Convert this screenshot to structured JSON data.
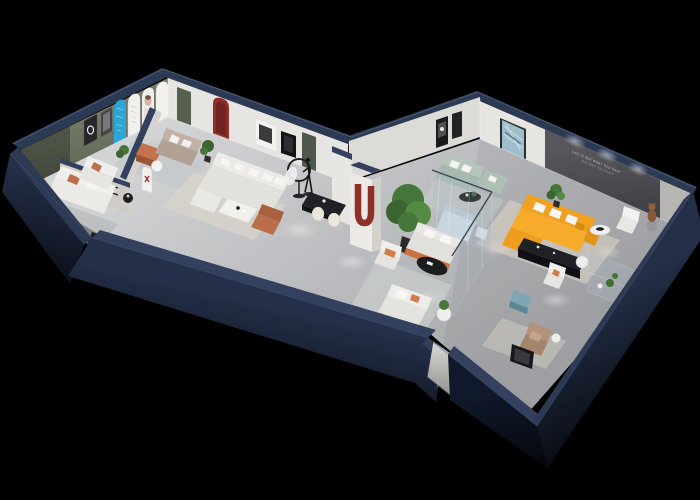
{
  "wall_slogan": {
    "line1": "LIFE IS NOT WHAT YOU HAVE",
    "line2": "BUT WHAT YOU ENJOY"
  },
  "scene_elements": {
    "left_wing": [
      "olive accent wall with framed art",
      "blue arch display panel",
      "white arch panels with portrait",
      "sage green doors",
      "dark red arch niche",
      "white sectional sofa",
      "dining table with cream chairs",
      "mannequin sculpture",
      "ring floor lamp",
      "black media console",
      "terracotta ottoman"
    ],
    "junction": [
      "white pillar with dark red U arch",
      "large potted plant",
      "orange trimmed sofas",
      "black oval coffee table",
      "entrance door"
    ],
    "right_wing": [
      "orange L-shaped sectional",
      "dark slogan accent wall",
      "mint sofa with blue abstract painting",
      "glass partitions",
      "black media console",
      "white armchairs",
      "teddy bear on stool",
      "teal ottoman",
      "tan lounge chair",
      "glass plant display"
    ]
  },
  "palette": {
    "bg": "#000000",
    "navyTop": "#2c3a54",
    "navyTop2": "#33415e",
    "navyFaceA": "#243049",
    "navyFaceB": "#10192b",
    "floorLight": "#d3d4d6",
    "floorDark": "#a7a8ac",
    "wallWhite": "#e7e5e1",
    "wallShade": "#c9c7c3",
    "olive": "#727a66",
    "oliveDk": "#596050",
    "accentWall": "#56565c",
    "accentWallDk": "#3f3f45",
    "blueArch": "#2ba6d9",
    "darkRed": "#8e2f28",
    "sage": "#55604e",
    "orange": "#f2a01f",
    "orangeLt": "#f6ab2b",
    "orangeDk": "#d88a10",
    "terracotta": "#b96f49",
    "terracottaDk": "#9c5634",
    "taupe": "#b2a295",
    "mint": "#b4c6bc",
    "teal": "#7fa6b4",
    "tan": "#b3927c",
    "plantA": "#47763a",
    "plantB": "#3a6430",
    "blackFurn": "#1e1f23",
    "blackFurnDk": "#0f1013",
    "whiteSoft": "#f2f1ee",
    "cream": "#ece7dc",
    "rugWarm": "#dbd2c3",
    "rugCool": "#c2c7ca",
    "rugLiving": "#d8d4c9",
    "glassTint": "#aebfca",
    "glassEdge": "#e6edf2",
    "photoPeach": "#d9b3a2",
    "artBlue": "#9fbecb",
    "bearBrown": "#8a5a38"
  }
}
